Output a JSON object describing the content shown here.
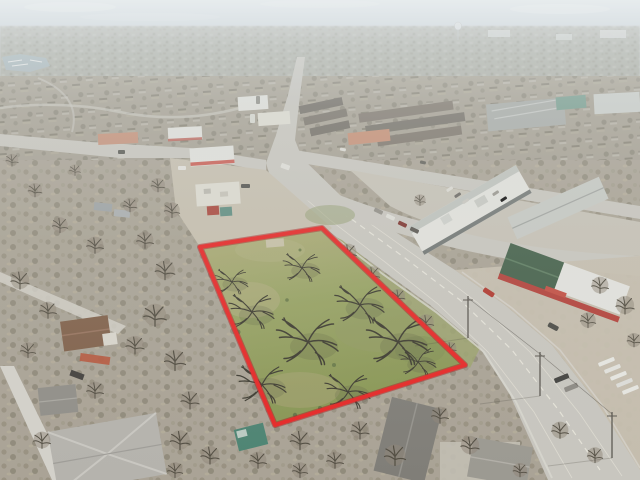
{
  "meta": {
    "type": "aerial-drone-photograph",
    "subject": "vacant land parcel outlined in red (real-estate listing photo)",
    "setting": "suburban commercial corridor, winter with leafless trees, hazy pale sky at horizon",
    "camera": "oblique aerial view looking toward horizon"
  },
  "parcel": {
    "outline_points": "200,247 322,228 465,365 275,425",
    "boundary_color": "#e8201f",
    "boundary_outer_color": "#a81114",
    "description": "trapezoidal grassy lot with scattered bare spreading trees, highlighted green"
  },
  "colors": {
    "road": "#c8c6bf",
    "road-light": "#d4d2ca",
    "apron": "#c6bfae",
    "verge": "#9aa169",
    "roof-white": "#e4e4de",
    "roof-gray": "#a6aaa7",
    "roof-dark": "#6e6a60",
    "roof-brown": "#7d5c45",
    "roof-green": "#3f5d45",
    "wall-red": "#b23c34",
    "salmon": "#c68a6e",
    "teal-roof": "#719b8c",
    "water": "#a2b2b8",
    "canopy": "#8b8274",
    "branch": "#4c473b",
    "branch-dark": "#37352a",
    "sky-top": "#ccd6dc",
    "grass-base": "#95a05f",
    "red-car": "#b03228"
  },
  "landmarks": [
    {
      "name": "outlined-vacant-parcel",
      "description": "red-outlined grassy lot at center-left with bare trees"
    },
    {
      "name": "main-arterial-road",
      "description": "wide multi-lane road from top center to bottom right along east side of parcel"
    },
    {
      "name": "cross-street-intersection",
      "description": "road junction north of the parcel"
    },
    {
      "name": "gas-station",
      "description": "white canopy fuel station north-west of parcel"
    },
    {
      "name": "strip-mall",
      "description": "long white retail strip buildings east of the intersection"
    },
    {
      "name": "red-feed-store",
      "description": "red building with dark green gabled roof across the road from the parcel"
    },
    {
      "name": "truck-parking",
      "description": "rows of white trailers parked at lower right"
    },
    {
      "name": "residential-neighborhood",
      "description": "single family homes with gray and brown roofs at left and bottom"
    },
    {
      "name": "marina-lake",
      "description": "small lake with white boat docks at upper left"
    },
    {
      "name": "water-tower",
      "description": "distant white water tower near horizon"
    },
    {
      "name": "hazy-skyline",
      "description": "flat hazy suburban horizon under pale sky"
    }
  ]
}
